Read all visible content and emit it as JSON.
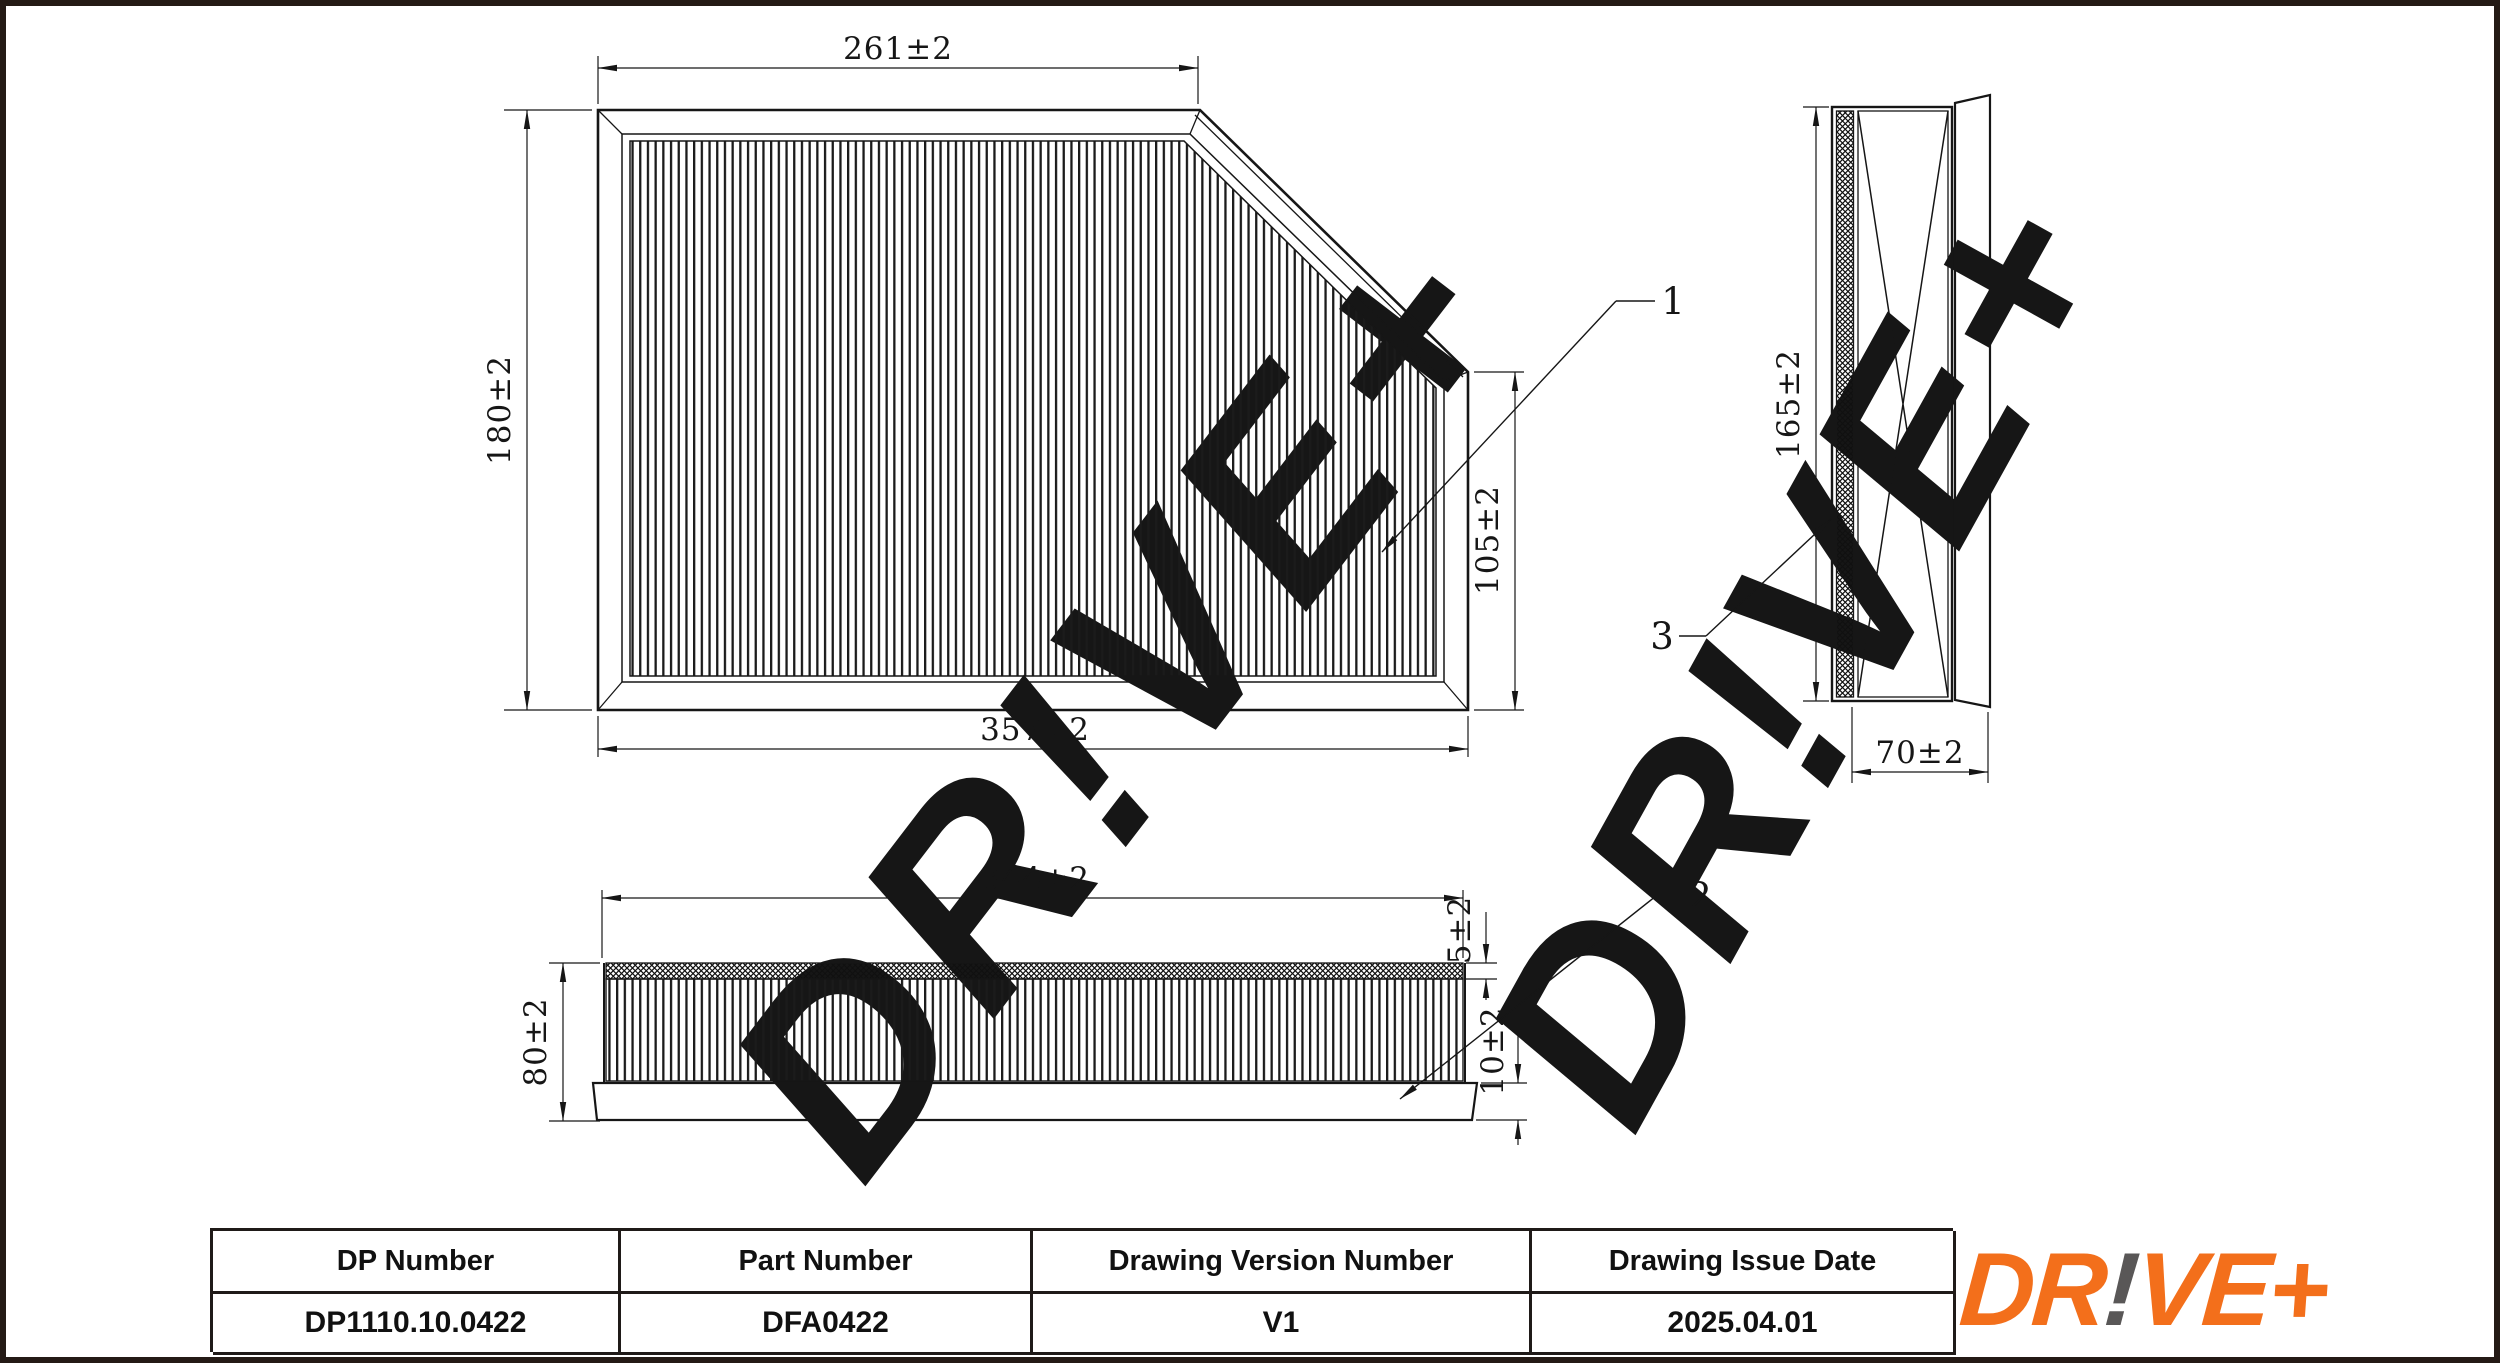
{
  "sheet": {
    "background": "#ffffff",
    "border_color": "#241a15",
    "line_color": "#161616"
  },
  "watermark": {
    "text": "DR!VE+",
    "color": "#ececec"
  },
  "views": {
    "plan": {
      "dim_top": "261±2",
      "dim_left": "180±2",
      "dim_bottom": "357±2",
      "dim_right": "105±2",
      "callout": "1"
    },
    "side": {
      "dim_height": "165±2",
      "dim_depth": "70±2",
      "callout": "3"
    },
    "front": {
      "dim_width": "344±2",
      "dim_media": "5±2",
      "dim_height": "80±2",
      "dim_frame": "10±2",
      "callout": "2"
    }
  },
  "title_block": {
    "columns": [
      {
        "header": "DP Number",
        "value": "DP1110.10.0422"
      },
      {
        "header": "Part Number",
        "value": "DFA0422"
      },
      {
        "header": "Drawing Version Number",
        "value": "V1"
      },
      {
        "header": "Drawing Issue Date",
        "value": "2025.04.01"
      }
    ]
  },
  "logo": {
    "dr": "DR",
    "bang": "!",
    "ve": "VE",
    "plus": "+",
    "orange": "#F36F1B",
    "gray": "#595757"
  }
}
